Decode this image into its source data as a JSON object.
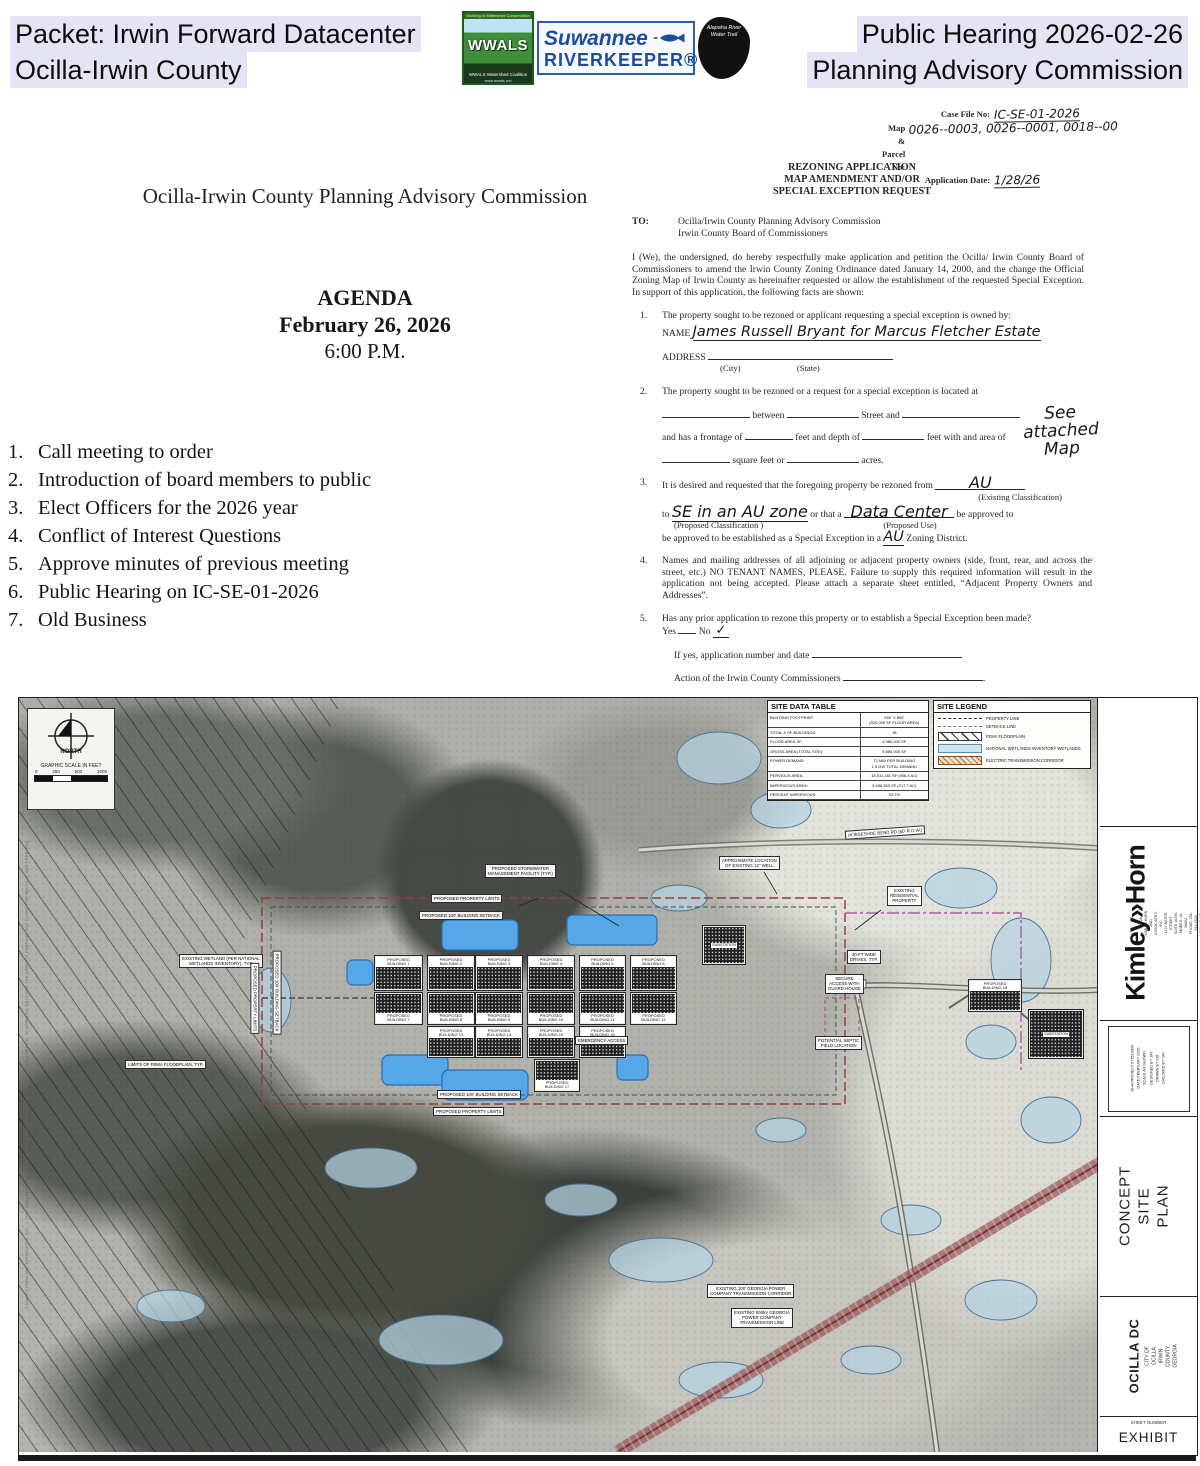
{
  "header": {
    "packet_line1": "Packet: Irwin Forward Datacenter",
    "packet_line2": "Ocilla-Irwin County",
    "right_line1": "Public Hearing 2026-02-26",
    "right_line2": "Planning Advisory Commission",
    "logos": {
      "wwals_top": "Working in Watershed Conservation",
      "wwals_name": "WWALS",
      "wwals_bottom": "WWALS Watershed Coalition",
      "wwals_url": "www.wwals.net",
      "rk_line1": "Suwannee",
      "rk_line2": "RIVERKEEPER®",
      "alapaha": "Alapaha River\nWater Trail"
    }
  },
  "agenda": {
    "org_title": "Ocilla-Irwin County Planning Advisory Commission",
    "heading": "AGENDA",
    "date": "February 26, 2026",
    "time": "6:00 P.M.",
    "items": [
      "Call meeting to order",
      "Introduction of board members to public",
      "Elect Officers for the 2026 year",
      "Conflict of Interest Questions",
      "Approve minutes of previous meeting",
      "Public Hearing on IC-SE-01-2026",
      "Old Business"
    ]
  },
  "form": {
    "case": {
      "file_label": "Case File No:",
      "file_value": "IC-SE-01-2026",
      "parcel_label": "Map & Parcel No:",
      "parcel_value": "0026--0003, 0026--0001, 0018--00",
      "date_label": "Application Date:",
      "date_value": "1/28/26"
    },
    "title1": "REZONING APPLICATION",
    "title2": "MAP AMENDMENT AND/OR",
    "title3": "SPECIAL EXCEPTION REQUEST",
    "to_label": "TO:",
    "to_line1": "Ocilla/Irwin County Planning Advisory Commission",
    "to_line2": "Irwin County Board of Commissioners",
    "intro": "I (We), the undersigned, do hereby respectfully make application and petition the Ocilla/ Irwin County Board of Commissioners to amend the Irwin County Zoning Ordinance dated January 14, 2000, and the change the Official Zoning Map of Irwin County as hereinafter requested or allow the establishment of the requested Special Exception.  In support of this application, the following facts are shown:",
    "i1": {
      "num": "1.",
      "text": "The property sought to be rezoned or applicant requesting a special exception is owned by:",
      "name_label": "NAME",
      "name_value": "James Russell Bryant for Marcus Fletcher Estate",
      "address_label": "ADDRESS",
      "city": "(City)",
      "state": "(State)"
    },
    "i2": {
      "num": "2.",
      "text": "The property sought to be rezoned or a request for a special exception is located at",
      "between": "between",
      "street_and": "Street and",
      "see_map": "See attached\nMap",
      "frontage": "and has a frontage of",
      "feet_depth": "feet and depth of",
      "feet_area": "feet with and area of",
      "sqft": "square feet or",
      "acres": "acres."
    },
    "i3": {
      "num": "3.",
      "lead": "It is desired and requested that the foregoing property be rezoned from",
      "ex_class": "AU",
      "ex_caption": "(Existing Classification)",
      "to_word": "to",
      "prop_class": "SE in an AU zone",
      "or_that": "or that a",
      "prop_use": "Data Center",
      "approved": "be approved  to",
      "prop_class_caption": "(Proposed Classification )",
      "prop_use_caption": "(Proposed Use)",
      "tail1": "be approved to be established as a Special Exception in a",
      "tail_zone": "AU",
      "tail2": "Zoning District."
    },
    "i4": {
      "num": "4.",
      "text": "Names and mailing addresses of all adjoining or adjacent property owners (side, front, rear, and across the street, etc.) NO TENANT NAMES, PLEASE. Failure to supply this required information will result in the application not being accepted. Please attach a separate sheet entitled, “Adjacent Property Owners and Addresses”."
    },
    "i5": {
      "num": "5.",
      "q": "Has any prior application to rezone this property or to establish a Special Exception been made?",
      "yes": "Yes",
      "no": "No",
      "check": "✓",
      "ifyes": "If yes, application number and date",
      "action": "Action of the Irwin County Commissioners"
    }
  },
  "site_plan": {
    "north_label": "NORTH",
    "scale_label": "GRAPHIC SCALE IN FEET",
    "scale_t0": "0",
    "scale_t1": "250",
    "scale_t2": "500",
    "scale_t3": "1000",
    "data_table": {
      "title": "SITE DATA TABLE",
      "rows": [
        {
          "label": "BUILDING FOOTPRINT:",
          "value": "650' X 800'\n(520,000 SF FLOOR AREA)"
        },
        {
          "label": "TOTAL # OF BUILDINGS:",
          "value": "18"
        },
        {
          "label": "FLOOR AREA SF:",
          "value": "9,360,000 SF"
        },
        {
          "label": "GROSS AREA (TOTAL SITE):",
          "value": "9,880,000 SF"
        },
        {
          "label": "POWER DEMAND:",
          "value": "72 MW PER BUILDING\n1.3 GW TOTAL DEMAND"
        },
        {
          "label": "PERVIOUS AREA:",
          "value": "18,511,181 SF (406.4 AC)"
        },
        {
          "label": "IMPERVIOUS AREA:",
          "value": "9,456,353 SF (217.7 AC)"
        },
        {
          "label": "PERCENT IMPERVIOUS:",
          "value": "33.7%"
        }
      ]
    },
    "legend": {
      "title": "SITE LEGEND",
      "entries": [
        {
          "label": "PROPERTY LINE",
          "swatch": "sw-property"
        },
        {
          "label": "SETBACK LINE",
          "swatch": "sw-setback"
        },
        {
          "label": "FEMA FLOODPLAIN",
          "swatch": "sw-fema"
        },
        {
          "label": "NATIONAL WETLANDS INVENTORY WETLANDS",
          "swatch": "sw-wetland"
        },
        {
          "label": "ELECTRIC TRANSMISSION CORRIDOR",
          "swatch": "sw-corridor"
        }
      ]
    },
    "buildings": [
      {
        "n": 1,
        "label": "PROPOSED\nBUILDING 1",
        "x": 356,
        "y": 258,
        "w": 47,
        "h": 34,
        "lp": "top"
      },
      {
        "n": 2,
        "label": "PROPOSED\nBUILDING 2",
        "x": 409,
        "y": 258,
        "w": 46,
        "h": 34,
        "lp": "top"
      },
      {
        "n": 3,
        "label": "PROPOSED\nBUILDING 3",
        "x": 457,
        "y": 258,
        "w": 46,
        "h": 34,
        "lp": "top"
      },
      {
        "n": 4,
        "label": "PROPOSED\nBUILDING 4",
        "x": 509,
        "y": 258,
        "w": 46,
        "h": 34,
        "lp": "top"
      },
      {
        "n": 5,
        "label": "PROPOSED\nBUILDING 5",
        "x": 561,
        "y": 258,
        "w": 45,
        "h": 34,
        "lp": "top"
      },
      {
        "n": 6,
        "label": "PROPOSED\nBUILDING 6",
        "x": 612,
        "y": 258,
        "w": 45,
        "h": 34,
        "lp": "top"
      },
      {
        "n": 7,
        "label": "PROPOSED\nBUILDING 7",
        "x": 356,
        "y": 295,
        "w": 47,
        "h": 31,
        "lp": "bottom"
      },
      {
        "n": 8,
        "label": "PROPOSED\nBUILDING 8",
        "x": 409,
        "y": 295,
        "w": 46,
        "h": 31,
        "lp": "bottom"
      },
      {
        "n": 9,
        "label": "PROPOSED\nBUILDING 9",
        "x": 457,
        "y": 295,
        "w": 46,
        "h": 31,
        "lp": "bottom"
      },
      {
        "n": 10,
        "label": "PROPOSED\nBUILDING 10",
        "x": 509,
        "y": 295,
        "w": 46,
        "h": 31,
        "lp": "bottom"
      },
      {
        "n": 11,
        "label": "PROPOSED\nBUILDING 11",
        "x": 561,
        "y": 295,
        "w": 45,
        "h": 31,
        "lp": "bottom"
      },
      {
        "n": 12,
        "label": "PROPOSED\nBUILDING 12",
        "x": 612,
        "y": 295,
        "w": 45,
        "h": 31,
        "lp": "bottom"
      },
      {
        "n": 13,
        "label": "PROPOSED\nBUILDING 13",
        "x": 409,
        "y": 329,
        "w": 46,
        "h": 30,
        "lp": "top"
      },
      {
        "n": 14,
        "label": "PROPOSED\nBUILDING 14",
        "x": 457,
        "y": 329,
        "w": 46,
        "h": 30,
        "lp": "top"
      },
      {
        "n": 15,
        "label": "PROPOSED\nBUILDING 15",
        "x": 509,
        "y": 329,
        "w": 46,
        "h": 30,
        "lp": "top"
      },
      {
        "n": 16,
        "label": "PROPOSED\nBUILDING 16",
        "x": 561,
        "y": 329,
        "w": 45,
        "h": 30,
        "lp": "top"
      },
      {
        "n": 17,
        "label": "PROPOSED\nBUILDING 17",
        "x": 516,
        "y": 362,
        "w": 44,
        "h": 31,
        "lp": "bottom"
      },
      {
        "n": 18,
        "label": "PROPOSED\nBUILDING 18",
        "x": 950,
        "y": 282,
        "w": 52,
        "h": 31,
        "lp": "top"
      }
    ],
    "substations": [
      {
        "label": "SUBSTATION",
        "x": 684,
        "y": 228,
        "w": 40,
        "h": 36
      },
      {
        "label": "SUBSTATION",
        "x": 1010,
        "y": 312,
        "w": 52,
        "h": 46
      }
    ],
    "labels": [
      {
        "text": "PROPOSED STORMWATER\nMANAGEMENT FACILITY (TYP.)",
        "x": 466,
        "y": 166
      },
      {
        "text": "PROPOSED PROPERTY LIMITS",
        "x": 412,
        "y": 196
      },
      {
        "text": "PROPOSED 100' BUILDING SETBACK",
        "x": 400,
        "y": 213
      },
      {
        "text": "APPROXIMATE LOCATION\nOF EXISTING 12\" WELL",
        "x": 700,
        "y": 158
      },
      {
        "text": "EXISTING\nRESIDENTIAL\nPROPERTY",
        "x": 868,
        "y": 188
      },
      {
        "text": "EXISTING WETLAND (PER NATIONAL\nWETLANDS INVENTORY), TYP.",
        "x": 160,
        "y": 256
      },
      {
        "text": "LIMITS OF FEMA FLOODPLAIN, TYP.",
        "x": 106,
        "y": 362
      },
      {
        "text": "30-FT WIDE\nDRIVES, TYP.",
        "x": 828,
        "y": 252
      },
      {
        "text": "SECURE\nACCESS WITH\nGUARD HOUSE",
        "x": 806,
        "y": 276
      },
      {
        "text": "POTENTIAL SEPTIC\nFIELD LOCATION",
        "x": 796,
        "y": 338
      },
      {
        "text": "EMERGENCY ACCESS",
        "x": 556,
        "y": 338
      },
      {
        "text": "PROPOSED 100' BUILDING SETBACK",
        "x": 418,
        "y": 392
      },
      {
        "text": "PROPOSED PROPERTY LIMITS",
        "x": 414,
        "y": 409
      },
      {
        "text": "EXISTING 100' GEORGIA POWER\nCOMPANY TRANSMISSION CORRIDOR",
        "x": 688,
        "y": 586
      },
      {
        "text": "EXISTING 500kV GEORGIA\nPOWER COMPANY\nTRANSMISSION LINE",
        "x": 712,
        "y": 610
      },
      {
        "text": "HORSESHOE BEND RD (60' R.O.W.)",
        "x": 826,
        "y": 130,
        "rot": -4
      },
      {
        "text": "PROPOSED PROPERTY LIMITS",
        "x": 200,
        "y": 296,
        "rot": 90
      },
      {
        "text": "PROPOSED 100' BUILDING SETBACK",
        "x": 216,
        "y": 290,
        "rot": 90
      }
    ],
    "titleblock": {
      "brand": "Kimley»Horn",
      "address": "© 2026 KIMLEY-HORN AND ASSOCIATES, INC.\n11 N WATER STREET, SUITE 10290, MOBILE, AL 36602\nPHONE: 251-344-4520\nWWW.KIMLEY-HORN.COM",
      "info": "KHA PROJECT  073510000\nDATE  FEBRUARY 2026\nSCALE  AS SHOWN\nDESIGNED BY  JAT\nDRAWN BY  JAT\nCHECKED BY  JAT",
      "sheet_title": "CONCEPT SITE\nPLAN",
      "project": "OCILLA DC",
      "project_sub": "CITY OF OCILLA\nIRWIN COUNTY, GEORGIA",
      "sheet_number_label": "SHEET NUMBER",
      "sheet_number": "EXHIBIT",
      "edge_note": "© KIMLEY-HORN AND ASSOCIATES, INC. — THIS DOCUMENT, TOGETHER WITH THE CONCEPTS AND DESIGNS PRESENTED HEREIN, IS INTENDED ONLY FOR THE SPECIFIC PURPOSE AND CLIENT FOR WHICH IT WAS PREPARED."
    }
  }
}
